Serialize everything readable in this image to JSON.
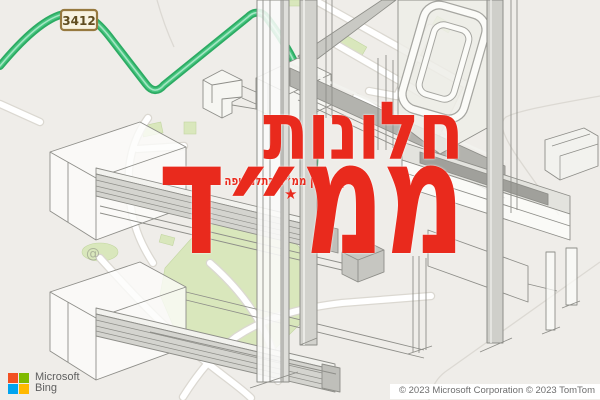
{
  "map": {
    "route_shield": "3412",
    "attribution": "© 2023 Microsoft Corporation © 2023 TomTom",
    "route_color": "#2cab63",
    "background_color": "#efede9"
  },
  "branding": {
    "microsoft_label": "Microsoft",
    "product_label": "Bing",
    "logo_colors": [
      "#f25022",
      "#7fba00",
      "#00a4ef",
      "#ffb900"
    ]
  },
  "overlay": {
    "headline_top": "חלונות",
    "headline_main": "ממ״ד",
    "tagline": "תיקון חלון ממ״ד בתלמי יפה",
    "star": "★",
    "watermark": "@",
    "accent_color": "#e92a1d"
  }
}
